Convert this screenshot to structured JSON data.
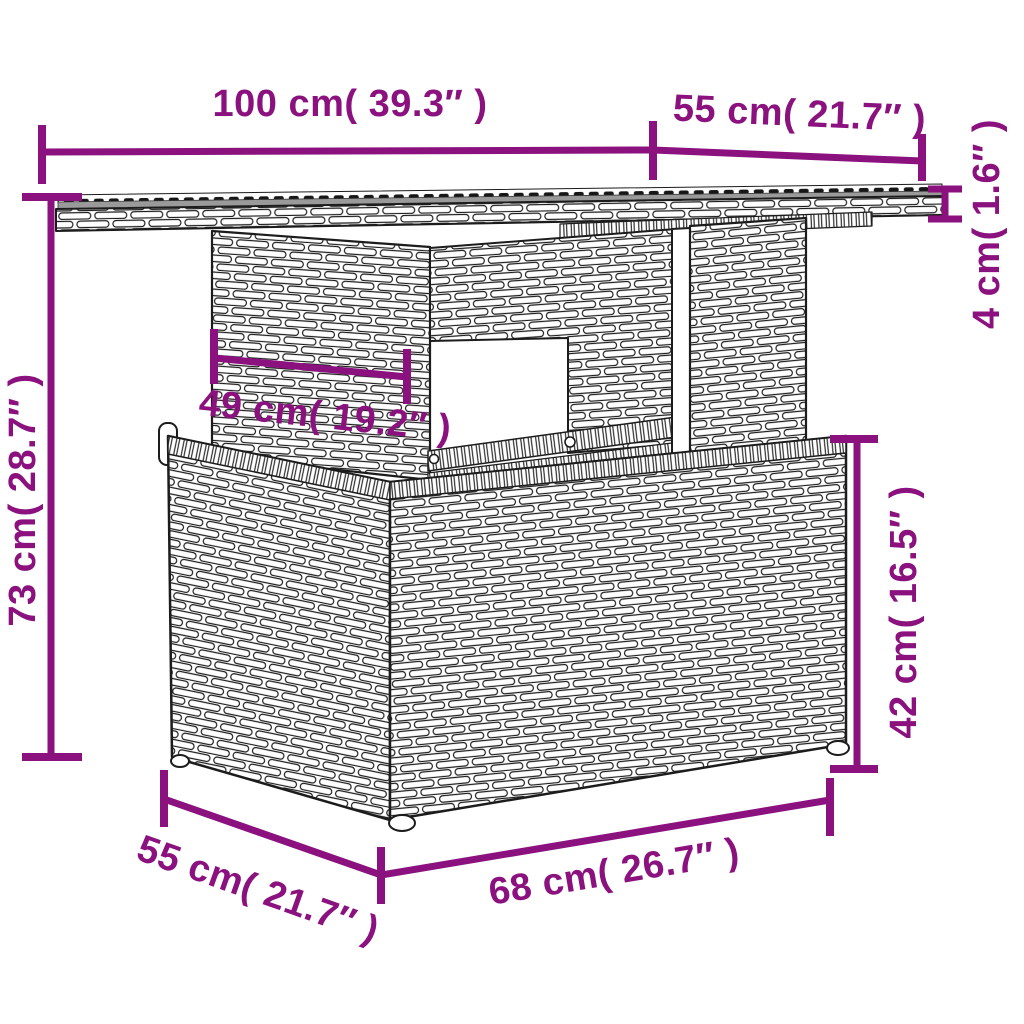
{
  "image": {
    "kind": "product dimension line drawing",
    "subject": "poly rattan garden table with storage base, perspective side view",
    "background_color": "#ffffff"
  },
  "colors": {
    "dimension_annotation": "#8A117E",
    "line_art": "#1c1c1c",
    "tabletop_surface": "#9a9a9a"
  },
  "dimensions": {
    "tabletop_width": {
      "cm": "100",
      "inches": "39.3",
      "label": "100 cm( 39.3″ )"
    },
    "tabletop_depth": {
      "cm": "55",
      "inches": "21.7",
      "label": "55 cm( 21.7″ )"
    },
    "tabletop_thickness": {
      "cm": "4",
      "inches": "1.6",
      "label": "4 cm( 1.6″ )"
    },
    "total_height": {
      "cm": "73",
      "inches": "28.7",
      "label": "73 cm( 28.7″ )"
    },
    "leg_panel_width": {
      "cm": "49",
      "inches": "19.2",
      "label": "49 cm( 19.2″ )"
    },
    "base_height": {
      "cm": "42",
      "inches": "16.5",
      "label": "42 cm( 16.5″ )"
    },
    "base_depth": {
      "cm": "55",
      "inches": "21.7",
      "label": "55 cm( 21.7″ )"
    },
    "base_width": {
      "cm": "68",
      "inches": "26.7",
      "label": "68 cm( 26.7″ )"
    }
  }
}
